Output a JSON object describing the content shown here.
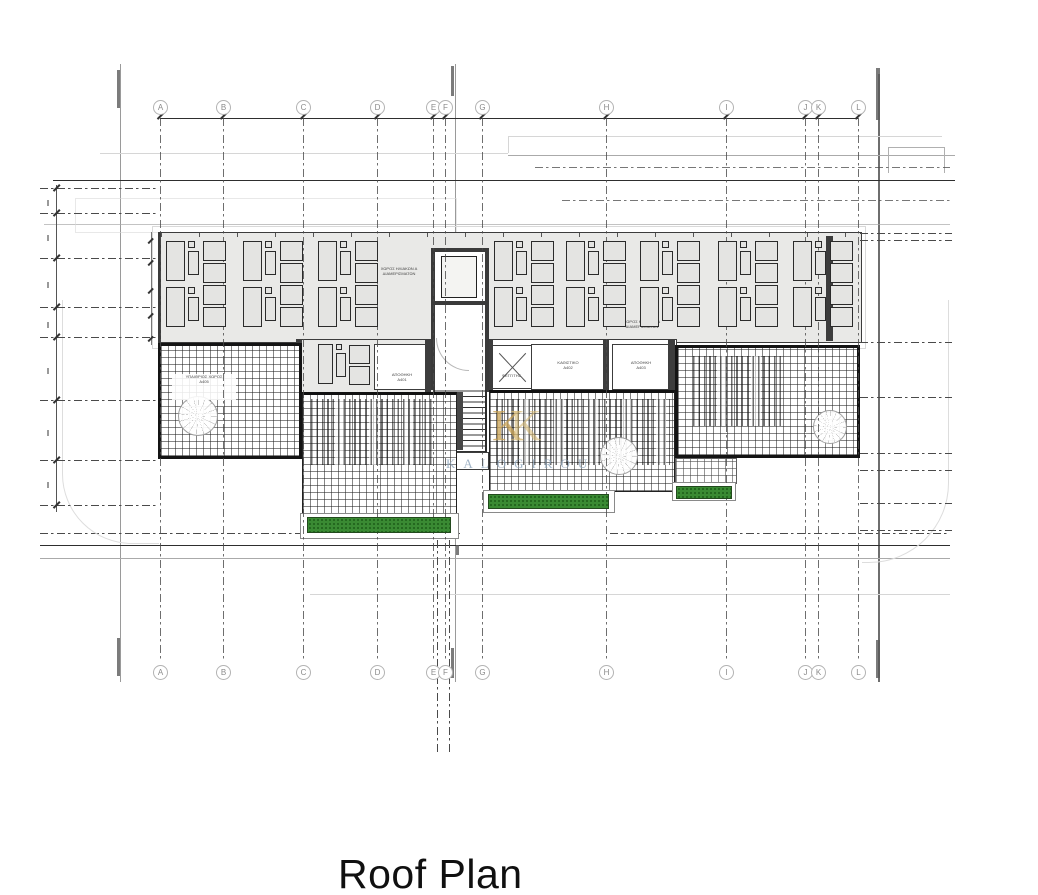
{
  "title": {
    "text": "Roof Plan"
  },
  "watermark": {
    "monogram": "K",
    "monogram2": "K",
    "name": "KALOGIROU",
    "logo_color": "#c9a254",
    "text_color": "#8ca3ba"
  },
  "grid": {
    "columns": [
      {
        "label": "A",
        "x": 160
      },
      {
        "label": "B",
        "x": 223
      },
      {
        "label": "C",
        "x": 303
      },
      {
        "label": "D",
        "x": 377
      },
      {
        "label": "E",
        "x": 433
      },
      {
        "label": "F",
        "x": 445
      },
      {
        "label": "G",
        "x": 482
      },
      {
        "label": "H",
        "x": 606
      },
      {
        "label": "I",
        "x": 726
      },
      {
        "label": "J",
        "x": 805
      },
      {
        "label": "K",
        "x": 818
      },
      {
        "label": "L",
        "x": 858
      }
    ],
    "line_top_y": 118,
    "line_bottom_y": 660,
    "bubble_top_y": 100,
    "bubble_bottom_y": 665
  },
  "annotations": {
    "solar_left_1": "ΧΩΡΟΣ ΗΛΙΑΚΩΝ Α",
    "solar_left_2": "ΔΙΑΜΕΡΙΣΜΑΤΩΝ",
    "solar_right_1": "ΧΩΡΟΣ ΗΛΙΑΚΩΝ Δ",
    "solar_right_2": "ΔΙΑΜΕΡΙΣΜΑΤΩΝ",
    "room1_1": "ΑΠΟΘΗΚΗ",
    "room1_2": "Α401",
    "room2_1": "ΚΑΘΙΣΤΙΚΟ",
    "room2_2": "Α402",
    "room3_1": "ΑΠΟΘΗΚΗ",
    "room3_2": "Α403",
    "pergola_1": "ΥΠΑΙΘΡΙΟΣ ΧΩΡΟΣ",
    "pergola_2": "Α405",
    "skylight": "ΦΕΓΓΙΤΗΣ"
  },
  "drawing_objects": {
    "solar_panel_groups": [
      {
        "x": 166,
        "y": 241
      },
      {
        "x": 243,
        "y": 241
      },
      {
        "x": 318,
        "y": 241
      },
      {
        "x": 494,
        "y": 241
      },
      {
        "x": 566,
        "y": 241
      },
      {
        "x": 640,
        "y": 241
      },
      {
        "x": 718,
        "y": 241
      },
      {
        "x": 793,
        "y": 241
      }
    ],
    "planters": [
      {
        "x": 307,
        "y": 517,
        "w": 142,
        "h": 14
      },
      {
        "x": 488,
        "y": 494,
        "w": 119,
        "h": 13
      },
      {
        "x": 676,
        "y": 486,
        "w": 54,
        "h": 11
      }
    ],
    "site_dash_left_y": [
      188,
      213,
      258,
      307,
      337,
      400,
      460,
      505
    ],
    "site_dash_right_y": [
      233,
      240,
      342,
      397,
      453,
      470,
      503,
      530
    ]
  },
  "colors": {
    "roof_slab": "#e9e9e7",
    "planter_green": "#3a8a33",
    "line_dark": "#2e2e2e",
    "line_light": "#d6d6d6"
  }
}
